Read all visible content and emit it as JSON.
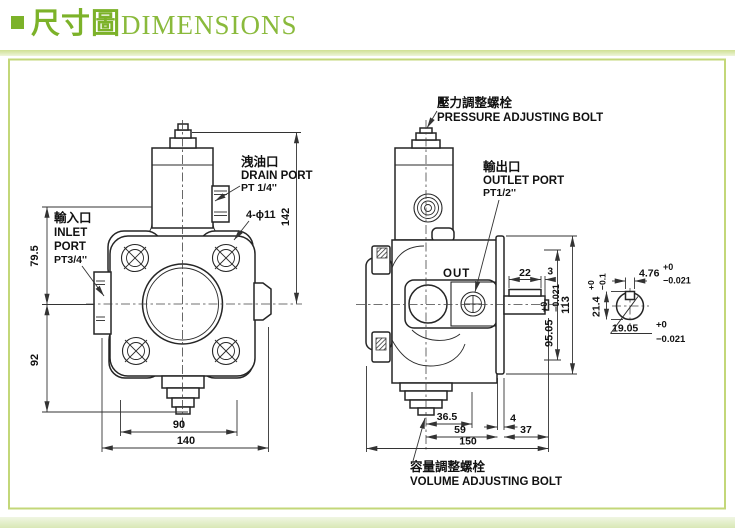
{
  "header": {
    "title_cjk": "尺寸圖",
    "title_en": "DIMENSIONS"
  },
  "front_view": {
    "inlet_label_cjk": "輸入口",
    "inlet_label_1": "INLET",
    "inlet_label_2": "PORT",
    "inlet_label_size": "PT3/4''",
    "drain_label_cjk": "洩油口",
    "drain_label_en": "DRAIN PORT",
    "drain_label_size": "PT 1/4''",
    "holes_label": "4-ϕ11",
    "dim_height_to_bolt": "142",
    "dim_inlet_to_top": "79.5",
    "dim_inlet_to_base": "92",
    "dim_bolt_spacing": "90",
    "dim_width": "140"
  },
  "side_view": {
    "pressure_label_cjk": "壓力調整螺栓",
    "pressure_label_en": "PRESSURE ADJUSTING BOLT",
    "outlet_label_cjk": "輸出口",
    "outlet_label_en": "OUTLET PORT",
    "outlet_label_size": "PT1/2''",
    "volume_label_cjk": "容量調整螺栓",
    "volume_label_en": "VOLUME ADJUSTING BOLT",
    "out_marking": "OUT",
    "dim_key_length": "22",
    "dim_key_end": "3",
    "dim_shaft_height": "95.05",
    "dim_shaft_height_tol_plus": "+0",
    "dim_shaft_height_tol_minus": "−0.021",
    "dim_total_height": "113",
    "dim_bolt_to_port": "36.5",
    "dim_bolt_to_flange": "59",
    "dim_total_length": "150",
    "dim_flange_thickness": "4",
    "dim_shaft_length": "37"
  },
  "shaft_section": {
    "dim_key_width": "4.76",
    "dim_key_width_tol_plus": "+0",
    "dim_key_width_tol_minus": "−0.021",
    "dim_height_over_key": "21.4",
    "dim_height_tol_plus": "+0",
    "dim_height_tol_minus": "−0.1",
    "dim_diameter": "19.05",
    "dim_diameter_tol_plus": "+0",
    "dim_diameter_tol_minus": "−0.021"
  },
  "colors": {
    "accent_green": "#7cb229",
    "frame_border": "#c3d779",
    "line": "#222222"
  }
}
